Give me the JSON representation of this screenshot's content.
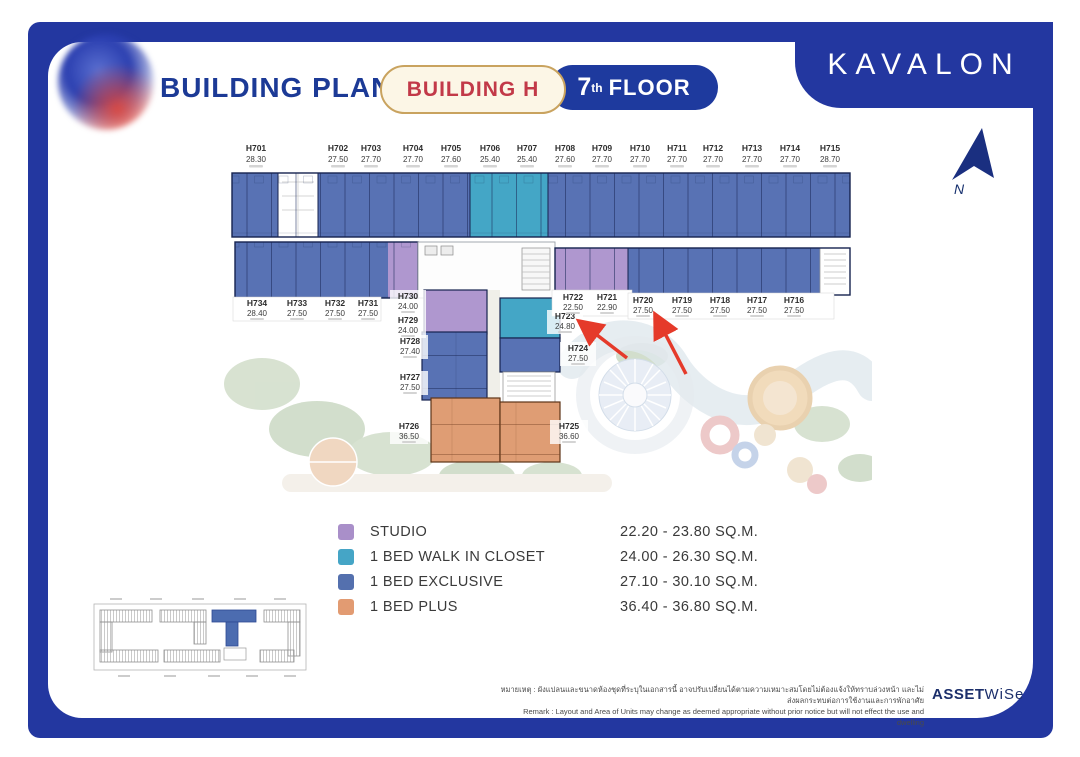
{
  "header": {
    "title": "BUILDING PLAN",
    "building_badge": "BUILDING H",
    "floor_number": "7",
    "floor_ordinal": "th",
    "floor_word": "FLOOR",
    "brand": "KAVALON"
  },
  "compass": {
    "label": "N"
  },
  "plan": {
    "units": [
      {
        "no": "H701",
        "area": "28.30"
      },
      {
        "no": "H702",
        "area": "27.50"
      },
      {
        "no": "H703",
        "area": "27.70"
      },
      {
        "no": "H704",
        "area": "27.70"
      },
      {
        "no": "H705",
        "area": "27.60"
      },
      {
        "no": "H706",
        "area": "25.40"
      },
      {
        "no": "H707",
        "area": "25.40"
      },
      {
        "no": "H708",
        "area": "27.60"
      },
      {
        "no": "H709",
        "area": "27.70"
      },
      {
        "no": "H710",
        "area": "27.70"
      },
      {
        "no": "H711",
        "area": "27.70"
      },
      {
        "no": "H712",
        "area": "27.70"
      },
      {
        "no": "H713",
        "area": "27.70"
      },
      {
        "no": "H714",
        "area": "27.70"
      },
      {
        "no": "H715",
        "area": "28.70"
      },
      {
        "no": "H734",
        "area": "28.40"
      },
      {
        "no": "H733",
        "area": "27.50"
      },
      {
        "no": "H732",
        "area": "27.50"
      },
      {
        "no": "H731",
        "area": "27.50"
      },
      {
        "no": "H730",
        "area": "24.00"
      },
      {
        "no": "H729",
        "area": "24.00"
      },
      {
        "no": "H728",
        "area": "27.40"
      },
      {
        "no": "H727",
        "area": "27.50"
      },
      {
        "no": "H722",
        "area": "22.50"
      },
      {
        "no": "H721",
        "area": "22.90"
      },
      {
        "no": "H720",
        "area": "27.50"
      },
      {
        "no": "H719",
        "area": "27.50"
      },
      {
        "no": "H718",
        "area": "27.50"
      },
      {
        "no": "H717",
        "area": "27.50"
      },
      {
        "no": "H716",
        "area": "27.50"
      },
      {
        "no": "H723",
        "area": "24.80"
      },
      {
        "no": "H724",
        "area": "27.50"
      },
      {
        "no": "H726",
        "area": "36.50"
      },
      {
        "no": "H725",
        "area": "36.60"
      }
    ],
    "unit_colors": {
      "studio": "#af97cf",
      "walk_in_closet": "#44a6c6",
      "exclusive": "#5872b4",
      "plus": "#df9d74",
      "wall": "#16234f"
    }
  },
  "legend": {
    "items": [
      {
        "label": "STUDIO",
        "range": "22.20 - 23.80 SQ.M.",
        "color": "#a98fc9",
        "swatch_style": "background:#a98fc9"
      },
      {
        "label": "1 BED WALK IN CLOSET",
        "range": "24.00 - 26.30 SQ.M.",
        "color": "#45a5c6",
        "swatch_style": "background:#45a5c6"
      },
      {
        "label": "1 BED EXCLUSIVE",
        "range": "27.10 - 30.10 SQ.M.",
        "color": "#5470ae",
        "swatch_style": "background:#5470ae"
      },
      {
        "label": "1 BED PLUS",
        "range": "36.40 - 36.80 SQ.M.",
        "color": "#e29b72",
        "swatch_style": "background:#e29b72"
      }
    ]
  },
  "footer": {
    "thai_note": "หมายเหตุ : ผังแปลนและขนาดห้องชุดที่ระบุในเอกสารนี้ อาจปรับเปลี่ยนได้ตามความเหมาะสมโดยไม่ต้องแจ้งให้ทราบล่วงหน้า และไม่ส่งผลกระทบต่อการใช้งานและการพักอาศัย",
    "remark": "Remark : Layout and Area of Units may change as deemed appropriate without prior notice but will not effect the use and dwelling",
    "brand_bold": "ASSET",
    "brand_light": "WiSe"
  }
}
